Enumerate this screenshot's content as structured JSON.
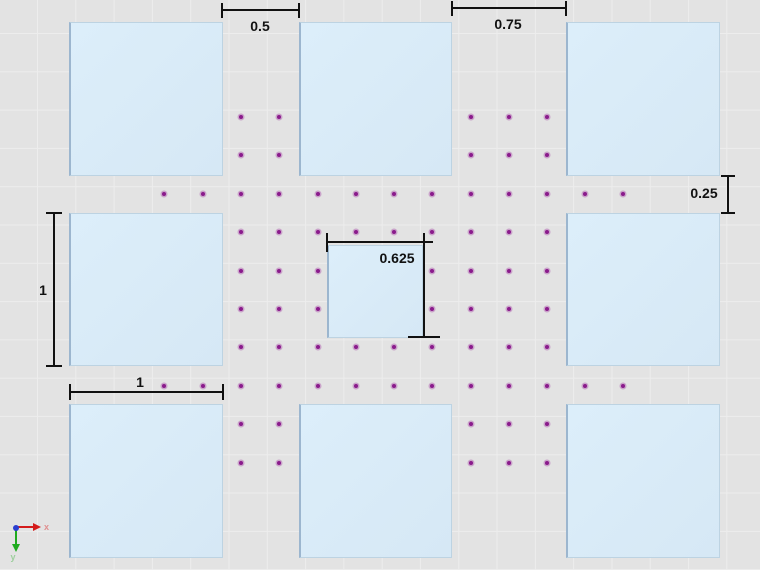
{
  "scene": {
    "width": 760,
    "height": 570,
    "background_color": "#e3e3e3",
    "grid_line_color": "#ededed",
    "grid_spacing_px": 38.3,
    "square_fill_color": "#d8eaf7",
    "square_edge_color": "#9cb6cf",
    "mesh_point_color": "#8a1b8c",
    "dimension_color": "#111111"
  },
  "squares": [
    {
      "name": "square-top-left",
      "x": 69,
      "y": 22,
      "w": 154,
      "h": 154
    },
    {
      "name": "square-top-middle",
      "x": 299,
      "y": 22,
      "w": 153,
      "h": 154
    },
    {
      "name": "square-top-right",
      "x": 566,
      "y": 22,
      "w": 154,
      "h": 154
    },
    {
      "name": "square-middle-left",
      "x": 69,
      "y": 213,
      "w": 154,
      "h": 153
    },
    {
      "name": "square-center-small",
      "x": 327,
      "y": 245,
      "w": 96,
      "h": 93
    },
    {
      "name": "square-middle-right",
      "x": 566,
      "y": 213,
      "w": 154,
      "h": 153
    },
    {
      "name": "square-bottom-left",
      "x": 69,
      "y": 404,
      "w": 154,
      "h": 154
    },
    {
      "name": "square-bottom-middle",
      "x": 299,
      "y": 404,
      "w": 153,
      "h": 154
    },
    {
      "name": "square-bottom-right",
      "x": 566,
      "y": 404,
      "w": 154,
      "h": 154
    }
  ],
  "mesh_points": {
    "columns_x": [
      164,
      203,
      241,
      279,
      318,
      356,
      394,
      432,
      471,
      509,
      547,
      585,
      623
    ],
    "rows_y": [
      117,
      155,
      194,
      232,
      271,
      309,
      347,
      386,
      424,
      463
    ],
    "rule": "dot drawn only where grid point is not covered by a square"
  },
  "dimensions": [
    {
      "name": "dim-gap-top-left",
      "label": "0.5",
      "orient": "h",
      "a": 222,
      "b": 299,
      "pos": 10,
      "tick_start": true,
      "tick_end": true,
      "tick_len": 15,
      "label_x": 260,
      "label_y": 26
    },
    {
      "name": "dim-gap-top-right",
      "label": "0.75",
      "orient": "h",
      "a": 452,
      "b": 566,
      "pos": 8,
      "tick_start": true,
      "tick_end": true,
      "tick_len": 15,
      "label_x": 508,
      "label_y": 24
    },
    {
      "name": "dim-gap-right",
      "label": "0.25",
      "orient": "v",
      "a": 176,
      "b": 213,
      "pos": 728,
      "tick_start": true,
      "tick_end": true,
      "tick_len": 14,
      "label_x": 704,
      "label_y": 193
    },
    {
      "name": "dim-left-square-height",
      "label": "1",
      "orient": "v",
      "a": 213,
      "b": 366,
      "pos": 54,
      "tick_start": true,
      "tick_end": true,
      "tick_len": 16,
      "label_x": 43,
      "label_y": 290
    },
    {
      "name": "dim-bottom-square-width",
      "label": "1",
      "orient": "h",
      "a": 70,
      "b": 223,
      "pos": 392,
      "tick_start": true,
      "tick_end": true,
      "tick_len": 16,
      "label_x": 140,
      "label_y": 382
    },
    {
      "name": "dim-center-square-width",
      "label": "0.625",
      "orient": "h",
      "a": 327,
      "b": 433,
      "pos": 242,
      "tick_start": true,
      "tick_end": false,
      "tick_len": 19,
      "label_x": 397,
      "label_y": 258
    },
    {
      "name": "dim-center-square-height",
      "label": "",
      "orient": "v",
      "a": 233,
      "b": 337,
      "pos": 424,
      "tick_start": false,
      "tick_end": true,
      "tick_len": 32,
      "label_x": 0,
      "label_y": 0
    }
  ],
  "axis_triad": {
    "x_label": "x",
    "y_label": "y",
    "x_arrow_color": "#d41b1b",
    "y_arrow_color": "#1faa1f",
    "origin_color": "#2b3fd0",
    "origin_x": 16,
    "origin_y": 528
  }
}
